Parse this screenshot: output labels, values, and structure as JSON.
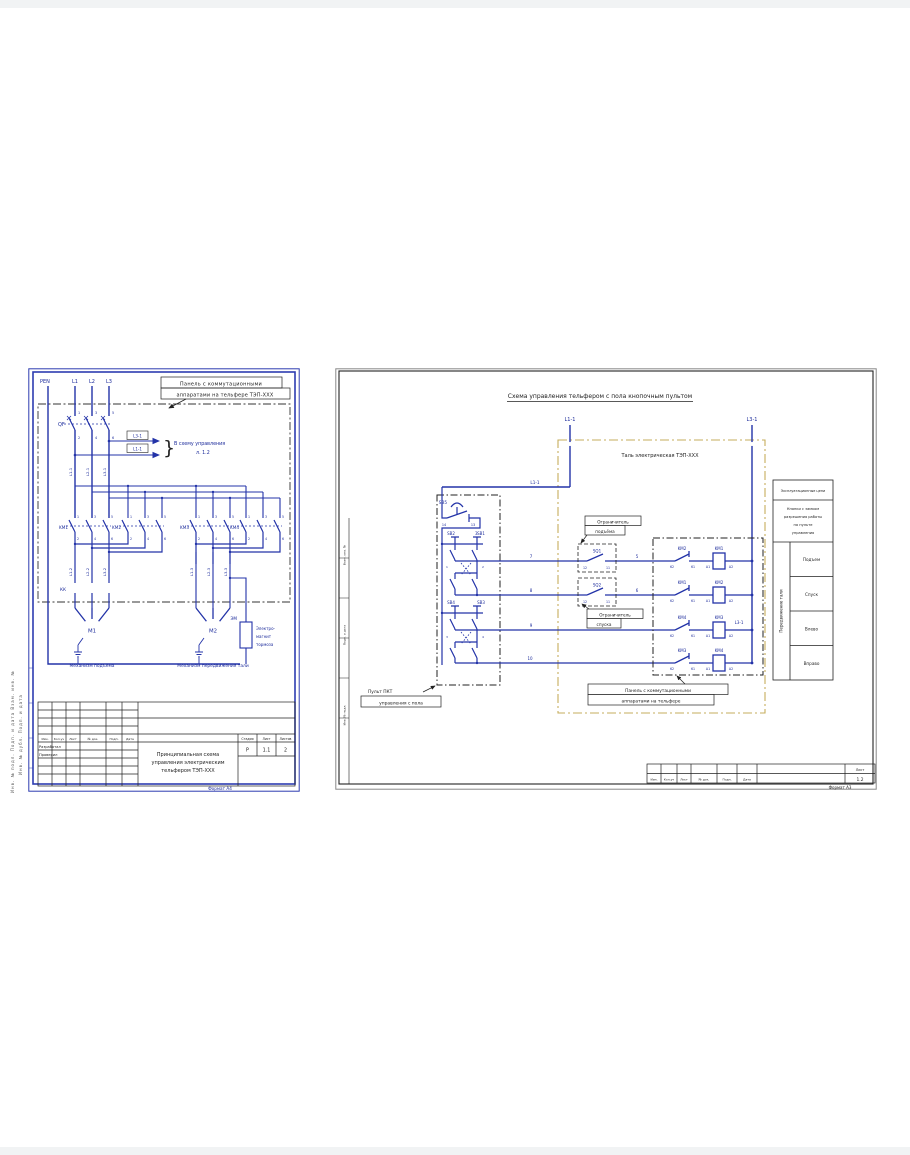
{
  "left": {
    "pen": "PEN",
    "phases": [
      "L1",
      "L2",
      "L3"
    ],
    "note1": "Панель с коммутационными",
    "note2": "аппаратами на тельфере ТЭП-ХХХ",
    "qf": "QF",
    "qf_top": [
      "1",
      "3",
      "5"
    ],
    "qf_bot": [
      "2",
      "4",
      "6"
    ],
    "branch1": "L3-1",
    "branch2": "L1-1",
    "brace": "}",
    "branch_text1": "В схему управления",
    "branch_text2": "л. 1.2",
    "wires1": [
      "L1-1",
      "L2-1",
      "L3-1"
    ],
    "km": [
      "KM1",
      "KM2",
      "KM3",
      "KM4"
    ],
    "cnum_top": [
      "1",
      "3",
      "5"
    ],
    "cnum_bot": [
      "2",
      "4",
      "6"
    ],
    "wires2": [
      "L1-2",
      "L2-2",
      "L3-2"
    ],
    "wires3": [
      "L1-3",
      "L2-3",
      "L3-3"
    ],
    "kk": "КК",
    "m1": "М1",
    "m2": "М2",
    "m1_caption": "Механизм подъёма",
    "m2_caption": "Механизм передвижения тали",
    "em": "ЭМ",
    "em_cap1": "Электро-",
    "em_cap2": "магнит",
    "em_cap3": "тормоза",
    "tb": {
      "cols": [
        "Изм.",
        "Кол.уч",
        "Лист",
        "№ док.",
        "Подп.",
        "Дата"
      ],
      "row1": "Разработал",
      "row2": "Проверил",
      "title1": "Принципиальная схема",
      "title2": "управления электрическим",
      "title3": "тельфером ТЭП-ХХХ",
      "h_stage": "Стадия",
      "h_sheet": "Лист",
      "h_sheets": "Листов",
      "stage": "Р",
      "sheet": "1.1",
      "sheets": "2"
    },
    "format": "Формат А4",
    "stamp_col1": "Инв. № подл.      Подп. и дата      Взам. инв. №",
    "stamp_col2": "Инв. № дубл.      Подп. и дата"
  },
  "right": {
    "title": "Схема управления тельфером с пола кнопочным пультом",
    "l1_top": "L1-1",
    "l3_top": "L3-1",
    "l1_feed": "L1-1",
    "tal": "Таль электрическая ТЭП-ХХХ",
    "sb5": "SB5",
    "sb5_n1": "14",
    "sb5_n2": "13",
    "w3": "3",
    "sb2": "SB2",
    "sb1": "SB1",
    "sb4": "SB4",
    "sb3": "SB3",
    "btn_n": [
      "1",
      "2",
      "3",
      "4"
    ],
    "w7": "7",
    "w8": "8",
    "w9": "9",
    "w10": "10",
    "w5": "5",
    "w6": "6",
    "sq1": "SQ1",
    "sq2": "SQ2",
    "sq_n1": "12",
    "sq_n2": "11",
    "sq1_cap1": "Ограничитель",
    "sq1_cap2": "подъёма",
    "sq2_cap1": "Ограничитель",
    "sq2_cap2": "спуска",
    "rows": [
      {
        "contact": "KM2",
        "coil": "KM1"
      },
      {
        "contact": "KM1",
        "coil": "KM2"
      },
      {
        "contact": "KM4",
        "coil": "KM3"
      },
      {
        "contact": "KM3",
        "coil": "KM4"
      }
    ],
    "c_n1": "62",
    "c_n2": "61",
    "coil_n1": "А1",
    "coil_n2": "А2",
    "l31_mid": "L3-1",
    "panel_note1": "Панель с коммутационными",
    "panel_note2": "аппаратами на тельфере",
    "pendant_note1": "Пульт ПКТ",
    "pendant_note2": "управления с пола",
    "table": {
      "header": "Эксплуатационные цепи",
      "lock1": "Кнопки с замком",
      "lock2": "разрешения работы",
      "lock3": "на пульте",
      "lock4": "управления",
      "vertical": "Передвижение тали",
      "rows": [
        "Подъем",
        "Спуск",
        "Влево",
        "Вправо"
      ]
    },
    "strip_cols": [
      "Изм.",
      "Кол.уч",
      "Лист",
      "№ док.",
      "Подп.",
      "Дата"
    ],
    "sheet_label": "Лист",
    "sheet_num": "1.2",
    "format": "Формат А3",
    "stamp": [
      "Взам. инв. №",
      "Подп. и дата",
      "Инв. № подл."
    ]
  }
}
